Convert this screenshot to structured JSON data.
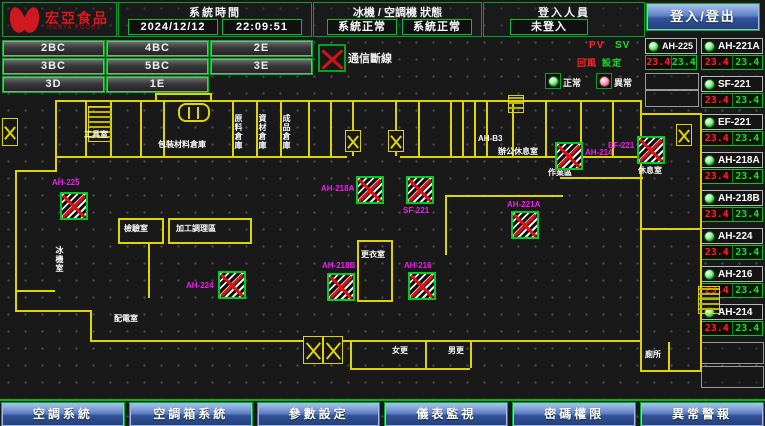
{
  "header": {
    "logo": {
      "title": "宏亞食品",
      "subtitle": "HUNYA FOODS"
    },
    "system_time": {
      "label": "系統時間",
      "date": "2024/12/12",
      "time": "22:09:51"
    },
    "machine_status": {
      "label": "冰機 / 空調機 狀態",
      "chiller_status": "系統正常",
      "ahu_status": "系統正常"
    },
    "login": {
      "label": "登入人員",
      "value": "未登入",
      "button_label": "登入/登出"
    }
  },
  "zones": [
    "2BC",
    "4BC",
    "2E",
    "3BC",
    "5BC",
    "3E",
    "3D",
    "1E"
  ],
  "legend": {
    "comm_loss": "通信斷線",
    "normal": "正常",
    "abnormal": "異常",
    "pv_header": "PV",
    "sv_header": "SV",
    "pv_label": "回風",
    "sv_label": "設定"
  },
  "unit_a": {
    "name": "AH-225",
    "pv": "23.4",
    "sv": "23.4"
  },
  "units": [
    {
      "name": "AH-221A",
      "pv": "23.4",
      "sv": "23.4"
    },
    {
      "name": "SF-221",
      "pv": "23.4",
      "sv": "23.4"
    },
    {
      "name": "EF-221",
      "pv": "23.4",
      "sv": "23.4"
    },
    {
      "name": "AH-218A",
      "pv": "23.4",
      "sv": "23.4"
    },
    {
      "name": "AH-218B",
      "pv": "23.4",
      "sv": "23.4"
    },
    {
      "name": "AH-224",
      "pv": "23.4",
      "sv": "23.4"
    },
    {
      "name": "AH-216",
      "pv": "23.4",
      "sv": "23.4"
    },
    {
      "name": "AH-214",
      "pv": "23.4",
      "sv": "23.4"
    }
  ],
  "plan": {
    "rooms": [
      {
        "label": "工具室",
        "x": 84,
        "y": 130
      },
      {
        "label": "包裝材料倉庫",
        "x": 158,
        "y": 140
      },
      {
        "label": "原料倉庫",
        "x": 234,
        "y": 114,
        "vertical": true
      },
      {
        "label": "資材倉庫",
        "x": 258,
        "y": 114,
        "vertical": true
      },
      {
        "label": "成品倉庫",
        "x": 282,
        "y": 114,
        "vertical": true
      },
      {
        "label": "AH-B3",
        "x": 478,
        "y": 134
      },
      {
        "label": "辦公休息室",
        "x": 498,
        "y": 147
      },
      {
        "label": "檢驗室",
        "x": 124,
        "y": 224
      },
      {
        "label": "加工調理區",
        "x": 176,
        "y": 224
      },
      {
        "label": "更衣室",
        "x": 361,
        "y": 250
      },
      {
        "label": "冰機室",
        "x": 55,
        "y": 246,
        "vertical": true
      },
      {
        "label": "配電室",
        "x": 114,
        "y": 314
      },
      {
        "label": "女更",
        "x": 392,
        "y": 346
      },
      {
        "label": "男更",
        "x": 448,
        "y": 346
      },
      {
        "label": "作業區",
        "x": 548,
        "y": 168
      },
      {
        "label": "休息室",
        "x": 638,
        "y": 166
      },
      {
        "label": "廁所",
        "x": 645,
        "y": 350
      }
    ],
    "markers": [
      {
        "label": "AH-225",
        "x": 60,
        "y": 192,
        "lx": 52,
        "ly": 178
      },
      {
        "label": "AH-224",
        "x": 218,
        "y": 271,
        "lx": 186,
        "ly": 281
      },
      {
        "label": "AH-218B",
        "x": 327,
        "y": 273,
        "lx": 322,
        "ly": 261
      },
      {
        "label": "AH-216",
        "x": 408,
        "y": 272,
        "lx": 404,
        "ly": 261
      },
      {
        "label": "AH-218A",
        "x": 356,
        "y": 176,
        "lx": 321,
        "ly": 184
      },
      {
        "label": "SF-221",
        "x": 406,
        "y": 176,
        "lx": 403,
        "ly": 206
      },
      {
        "label": "AH-221A",
        "x": 511,
        "y": 211,
        "lx": 507,
        "ly": 200
      },
      {
        "label": "AH-214",
        "x": 555,
        "y": 142,
        "lx": 585,
        "ly": 148
      },
      {
        "label": "EF-221",
        "x": 637,
        "y": 136,
        "lx": 608,
        "ly": 141
      }
    ]
  },
  "nav": [
    "空調系統",
    "空調箱系統",
    "參數設定",
    "儀表監視",
    "密碼權限",
    "異常警報"
  ],
  "colors": {
    "accent_green": "#00b424",
    "alarm_red": "#e01212",
    "value_red": "#ff2222",
    "value_green": "#17e021",
    "label_magenta": "#f01cf0",
    "wall_yellow": "#ded400",
    "button_blue": "#30539a",
    "logo_red": "#d01820"
  }
}
